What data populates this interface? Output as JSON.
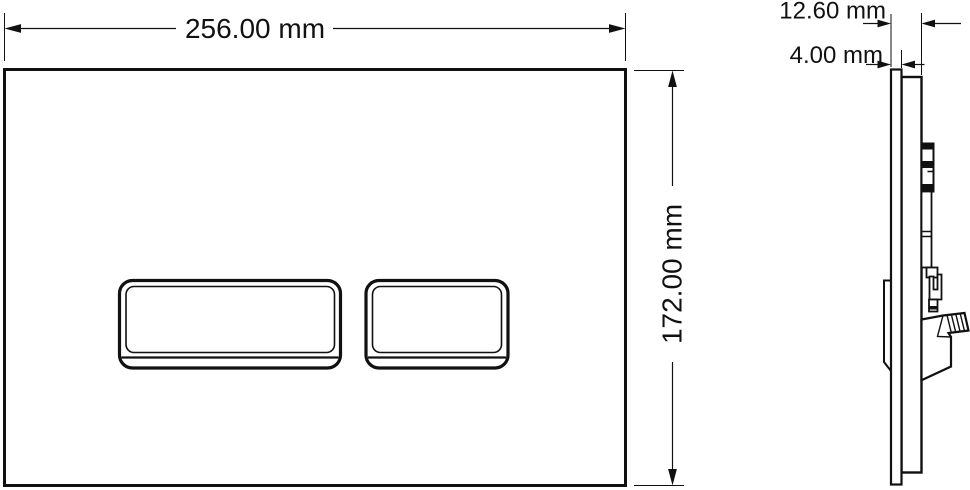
{
  "drawing": {
    "title": "flush-plate-technical-drawing",
    "front_view": {
      "width_label": "256.00 mm",
      "height_label": "172.00 mm"
    },
    "side_view": {
      "depth_label": "12.60 mm",
      "thickness_label": "4.00 mm"
    },
    "colors": {
      "line": "#111111",
      "background": "#ffffff"
    }
  }
}
